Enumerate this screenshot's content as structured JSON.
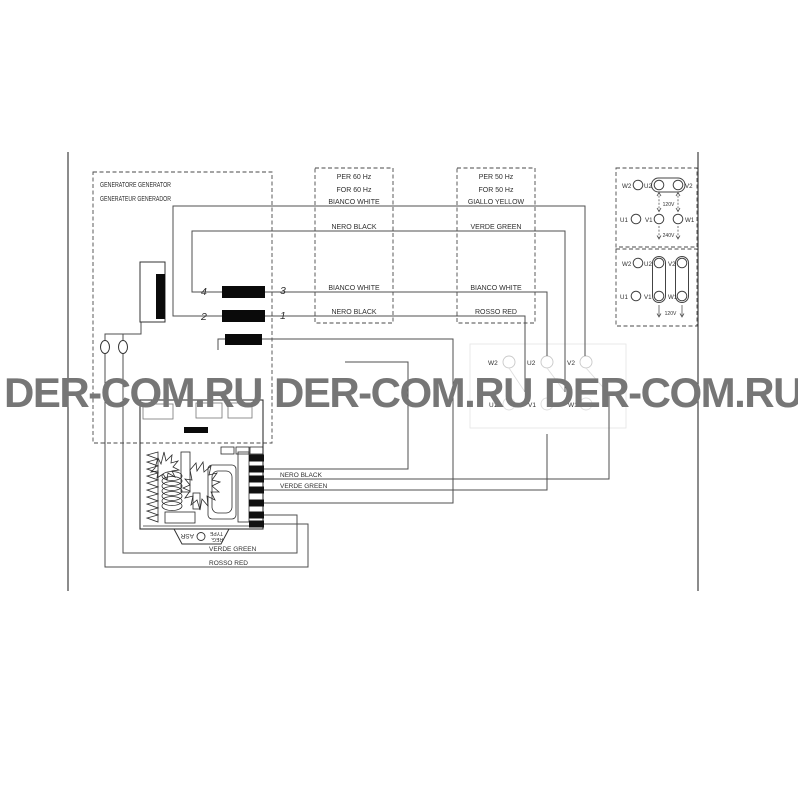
{
  "watermark": {
    "items": [
      "DER-COM.RU",
      "DER-COM.RU",
      "DER-COM.RU"
    ],
    "color": "#767676"
  },
  "generator_box": {
    "line1": "GENERATORE GENERATOR",
    "line2": "GENERATEUR GENERADOR"
  },
  "freq60_box": {
    "title1": "PER 60 Hz",
    "title2": "FOR 60 Hz",
    "wires": [
      "BIANCO WHITE",
      "NERO BLACK",
      "BIANCO WHITE",
      "NERO BLACK"
    ]
  },
  "freq50_box": {
    "title1": "PER 50 Hz",
    "title2": "FOR 50 Hz",
    "wires": [
      "GIALLO YELLOW",
      "VERDE GREEN",
      "BIANCO WHITE",
      "ROSSO RED"
    ]
  },
  "connector": {
    "terminals": [
      "4",
      "3",
      "2",
      "1"
    ]
  },
  "central_board": {
    "row1": [
      "W2",
      "U2",
      "V2"
    ],
    "row2": [
      "U1",
      "V1",
      "W1"
    ]
  },
  "regulator": {
    "plate_line1": "REG.",
    "plate_line2": "TYPE",
    "plate_type": "ASR",
    "wire_nero": "NERO BLACK",
    "wire_verde": "VERDE GREEN"
  },
  "bottom_wires": {
    "verde": "VERDE GREEN",
    "rosso": "ROSSO RED"
  },
  "terminal_block_240": {
    "row1": [
      "W2",
      "U2",
      "V2"
    ],
    "row2": [
      "U1",
      "V1",
      "W1"
    ],
    "dim_120": "120V",
    "dim_240": "240V"
  },
  "terminal_block_120": {
    "row1": [
      "W2",
      "U2",
      "V2"
    ],
    "row2": [
      "U1",
      "V1",
      "W1"
    ],
    "dim_120": "120V"
  },
  "colors": {
    "wire": "#4f4f4f",
    "bar": "#0a0a0a",
    "faint": "#c9c9c9"
  }
}
